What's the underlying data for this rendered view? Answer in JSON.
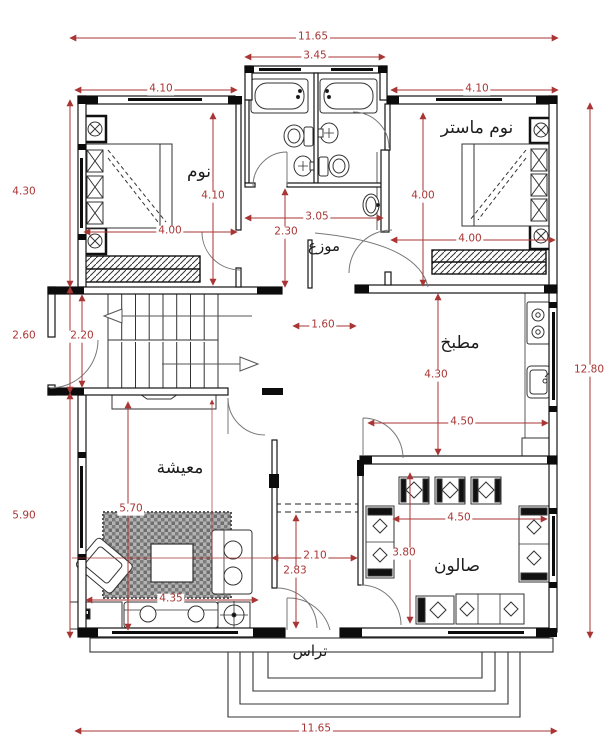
{
  "title": "Floor plan",
  "colors": {
    "dimension_red": "#a93535",
    "wall_black": "#111111",
    "carpet_gray": "#a8a8a8"
  },
  "rooms": {
    "bedroom": "نوم",
    "master_bedroom": "نوم ماستر",
    "hall": "موزع",
    "kitchen": "مطبخ",
    "living": "معيشة",
    "salon": "صالون",
    "terrace": "تراس"
  },
  "dimensions": {
    "top_total": "11.65",
    "top_bath": "3.45",
    "top_left": "4.10",
    "top_right": "4.10",
    "left_upper": "4.30",
    "left_mid": "2.60",
    "left_lower": "5.90",
    "right_total": "12.80",
    "bottom_total": "11.65",
    "bedroom_height": "4.10",
    "bedroom_width": "4.00",
    "hall_width": "3.05",
    "hall_depth": "2.30",
    "stair_depth": "2.20",
    "corridor_top": "1.60",
    "master_height": "4.00",
    "master_width": "4.00",
    "kitchen_height": "4.30",
    "kitchen_width": "4.50",
    "salon_width": "4.50",
    "salon_depth": "3.80",
    "living_height": "5.70",
    "living_width": "4.35",
    "corridor_width": "2.10",
    "corridor_length": "2.83"
  }
}
